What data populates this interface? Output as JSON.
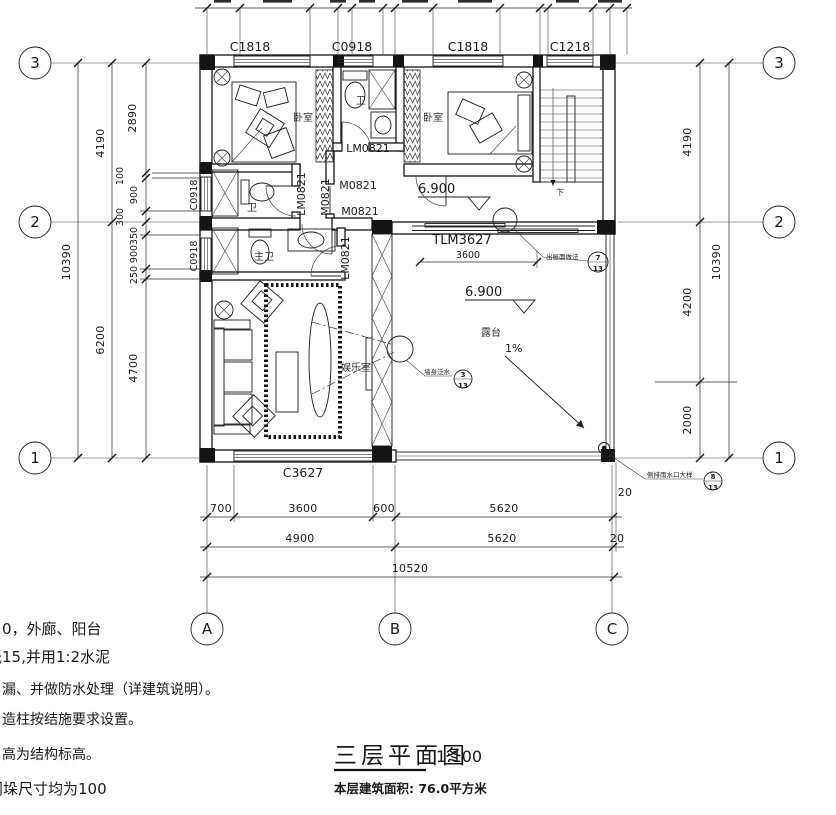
{
  "drawing": {
    "title": "三层平面图",
    "scale": "1:100",
    "area_note": "本层建筑面积: 76.0平方米"
  },
  "grid": {
    "rows": [
      "3",
      "2",
      "1"
    ],
    "cols": [
      "A",
      "B",
      "C"
    ]
  },
  "dims": {
    "left": [
      "10390",
      "4190",
      "6200",
      "2890",
      "100",
      "900",
      "300",
      "350",
      "900",
      "250",
      "4700"
    ],
    "right": [
      "4190",
      "10390",
      "4200",
      "2000"
    ],
    "bottom": [
      "700",
      "3600",
      "600",
      "5620",
      "20",
      "4900",
      "5620",
      "20",
      "10520"
    ],
    "terrace_door_width": "3600"
  },
  "windows": {
    "top": [
      "C1818",
      "C0918",
      "C1818",
      "C1218"
    ],
    "left": [
      "C0918",
      "C0918"
    ],
    "bottom": [
      "C3627"
    ]
  },
  "doors": [
    "LM0821",
    "M0821",
    "M0821",
    "LM0821",
    "M0821",
    "LM0821",
    "TLM3627"
  ],
  "rooms": {
    "bedroom_left": "卧室",
    "bedroom_right": "卧室",
    "bath_top": "卫",
    "bath_mid": "卫",
    "master_bath": "主卫",
    "rec_room": "娱乐室",
    "terrace": "露台"
  },
  "levels": [
    "6.900",
    "6.900"
  ],
  "slope_label": "1%",
  "stair_label": "下",
  "callouts": [
    {
      "label": "出屋面做法",
      "num": "7",
      "den": "13"
    },
    {
      "label": "墙身泛水",
      "num": "3",
      "den": "13"
    },
    {
      "label": "侧排雨水口大样",
      "num": "8",
      "den": "13"
    }
  ],
  "notes": [
    "0，外廊、阳台",
    "低15,并用1:2水泥",
    "漏、并做防水处理（详建筑说明）。",
    "造柱按结施要求设置。",
    "高为结构标高。",
    "门垛尺寸均为100"
  ]
}
